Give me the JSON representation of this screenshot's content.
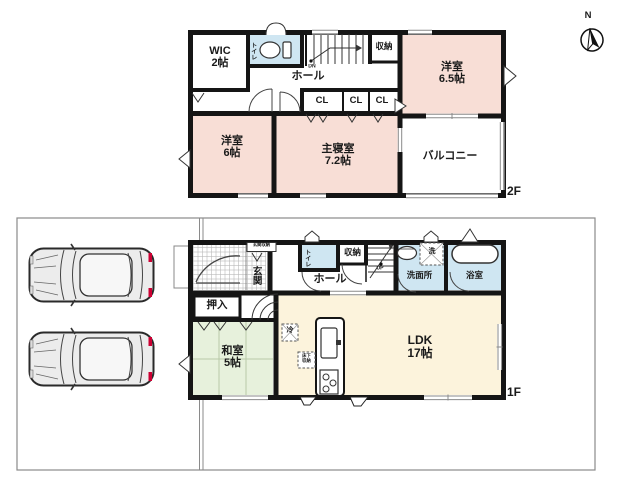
{
  "compass": {
    "north_label": "N"
  },
  "floor2": {
    "tag": "2F",
    "rooms": {
      "wic": {
        "name": "WIC",
        "size": "2帖"
      },
      "toilet": {
        "name": "トイレ"
      },
      "hall": {
        "name": "ホール"
      },
      "stairs": {
        "label": "DN"
      },
      "storage": {
        "name": "収納"
      },
      "closets": [
        "CL",
        "CL",
        "CL"
      ],
      "bedroom_65": {
        "name": "洋室",
        "size": "6.5帖"
      },
      "bedroom_6": {
        "name": "洋室",
        "size": "6帖"
      },
      "master_bedroom": {
        "name": "主寝室",
        "size": "7.2帖"
      },
      "balcony": {
        "name": "バルコニー"
      }
    }
  },
  "floor1": {
    "tag": "1F",
    "rooms": {
      "entrance": {
        "name": "玄関",
        "storage_label": "玄関収納"
      },
      "toilet": {
        "name": "トイレ"
      },
      "storage": {
        "name": "収納"
      },
      "stairs": {
        "label": "UP"
      },
      "hall": {
        "name": "ホール"
      },
      "washroom": {
        "name": "洗面所",
        "washer_label": "洗"
      },
      "bathroom": {
        "name": "浴室"
      },
      "oshiire": {
        "name": "押入"
      },
      "japanese_room": {
        "name": "和室",
        "size": "5帖"
      },
      "ldk": {
        "name": "LDK",
        "size": "17帖"
      },
      "refrigerator_label": "冷",
      "underfloor_storage": {
        "line1": "床下",
        "line2": "収納"
      }
    }
  },
  "colors": {
    "wall": "#151515",
    "bedroom_pink": "#f8ded6",
    "wet_area_blue": "#cfe6f2",
    "tatami_green": "#e7f1dc",
    "ldk_cream": "#fcf3dc",
    "taillight_red": "#c03",
    "lot_line": "#8a8a8a"
  }
}
